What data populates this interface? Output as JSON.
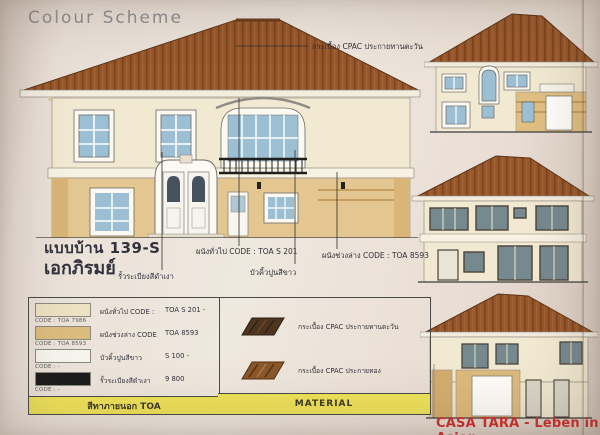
{
  "page": {
    "title": "Colour Scheme"
  },
  "model": {
    "code": "แบบบ้าน 139-S",
    "name": "เอกภิรมย์"
  },
  "annotations": {
    "roof_tile": "กระเบื้อง CPAC ประกายทานตะวัน",
    "railing_black": "รั้วระเบียงสีดำเงา",
    "wall_general": "ผนังทั่วไป CODE :   TOA S 201",
    "trim_white": "บัวคิ้วปูนสีขาว",
    "wall_lower": "ผนังช่วงล่าง CODE :   TOA 8593"
  },
  "paint_table": {
    "rows": [
      {
        "label": "ผนังทั่วไป CODE :",
        "value": "TOA S 201 -",
        "code": "CODE : TOA 7986",
        "swatch": "#ece2c2"
      },
      {
        "label": "ผนังช่วงล่าง CODE",
        "value": "TOA 8593",
        "code": "CODE : TOA 8593",
        "swatch": "#dcbc7e"
      },
      {
        "label": "บัวคิ้วปูนสีขาว",
        "value": "S 100 -",
        "code": "CODE : -",
        "swatch": "#f7f4ee"
      },
      {
        "label": "รั้วระเบียงสีดำเงา",
        "value": "9 800",
        "code": "CODE : -",
        "swatch": "#1c1c1c"
      }
    ],
    "footer": "สีทาภายนอก TOA"
  },
  "material_table": {
    "items": [
      {
        "label": "กระเบื้อง CPAC ประกายทานตะวัน",
        "tile_color": "#4d3520"
      },
      {
        "label": "กระเบื้อง CPAC ประกายทอง",
        "tile_color": "#8a572b"
      }
    ],
    "footer": "MATERIAL"
  },
  "watermark": "CASA TARA - Leben in Asien",
  "colors": {
    "roof": "#8f5226",
    "wall_cream": "#f1e9d1",
    "wall_tan": "#e4c690",
    "glass_blue": "#9dbfd3",
    "header_yellow": "#efe25a",
    "watermark_red": "#d03030"
  }
}
